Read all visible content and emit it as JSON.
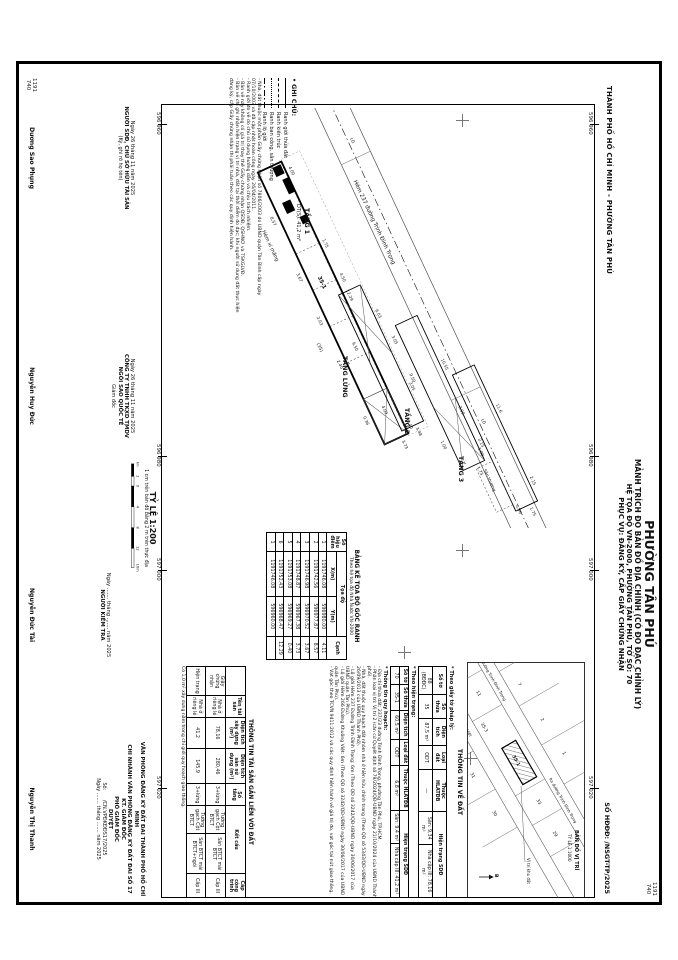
{
  "sheet": {
    "city_line": "THÀNH PHỐ HỒ CHÍ MINH - PHƯỜNG TÂN PHÚ",
    "title": "PHƯỜNG TÂN PHÚ",
    "subtitle1": "MẢNH TRÍCH ĐO BẢN ĐỒ ĐỊA CHÍNH (CÓ ĐO ĐẠC CHỈNH LÝ)",
    "subtitle2": "HỆ TỌA ĐỘ VN-2000, PHƯỜNG TÂN PHÚ, TỜ SỐ: 70",
    "subtitle3": "PHỤC VỤ: ĐĂNG KÝ, CẤP GIẤY CHỨNG NHẬN",
    "doc_no": "SỐ HĐĐĐ:  /NSGT-TP/2025"
  },
  "grid": {
    "ticks": [
      "596 960",
      "596 980",
      "597 000",
      "597 020"
    ],
    "corner_top": "1191",
    "corner_bottom": "740"
  },
  "legend": {
    "title": "• GHI CHÚ:",
    "items": [
      {
        "label": "Ranh giới thửa đất"
      },
      {
        "label": "Ranh kiến trúc"
      },
      {
        "label": "Ranh ban công, sân thượng"
      },
      {
        "label": "Ranh lộ giới"
      }
    ],
    "notes": [
      "- Nhà, đất thuộc một phần Giấy chứng nhận số 7806/2003 do UBND quận Tân Bình cấp ngày 07/10/2003 và đã cập nhật hoàn công ngày 26/04/2011.",
      "- Ranh giới đo vẽ do chủ sử dụng hướng dẫn và chịu trách nhiệm.",
      "- Bản vẽ này không có giá trị thay thế Giấy chứng nhận QSDĐ, QSHNƠ và TSKGLVĐ.",
      "- Bản vẽ chỉ ghi nhận hiện trạng vị trí nhà, đất tại thời điểm đo đạc; khi người sử dụng đất thực hiện đăng ký, cấp Giấy chứng nhận thì phải tuân theo các quy định hiện hành."
    ]
  },
  "map": {
    "street_label": "Hẻm 237 đường Trịnh Đình Trọng",
    "alley_label": "Hẻm xi măng",
    "lg_label": "LG",
    "parcel_label": "35-1",
    "parcel_alt": "(35)",
    "floors": [
      {
        "name": "TẦNG 1",
        "area": "DT(S): 41,2 m²",
        "dims": [
          "4.00",
          "1.75",
          "12.29",
          "0.40",
          "8.57",
          "3.67",
          "2.03",
          "2.40",
          "0.36",
          "3.73"
        ]
      },
      {
        "name": "TẦNG LỬNG",
        "dims": [
          "6.03",
          "3.05",
          "9.50",
          "4.09",
          "3.48",
          "4.50"
        ]
      },
      {
        "name": "TẦNG 2",
        "dims": [
          "10.55",
          "2.15",
          "9.50",
          "1.00",
          "1.75",
          "3.05"
        ]
      },
      {
        "name": "TẦNG 3",
        "dims": [
          "11.6",
          "2.15",
          "3.00",
          "1.00",
          "1.75",
          "0.36"
        ],
        "annex": "Sân thượng"
      }
    ]
  },
  "scale": {
    "title": "TỶ LỆ 1:200",
    "note": "1 cm trên bản đồ bằng 2 m trên thực địa",
    "bar_labels": [
      "4m",
      "2",
      "0",
      "4",
      "8",
      "12",
      "16m"
    ]
  },
  "coord_table": {
    "title": "BẢNG KÊ TỌA ĐỘ GÓC RANH",
    "subtitle": "Theo hệ tọa độ Nhà Nước VN-2000",
    "col_point": "Số hiệu điểm",
    "col_coord": "Tọa độ",
    "col_x": "X(m)",
    "col_y": "Y(m)",
    "col_edge": "Cạnh",
    "rows": [
      {
        "p": "1",
        "x": "1191746.08",
        "y": "596980.00",
        "c": "4.11"
      },
      {
        "p": "2",
        "x": "1191742.56",
        "y": "596977.87",
        "c": "8.57"
      },
      {
        "p": "3",
        "x": "1191746.98",
        "y": "596970.52",
        "c": "3.67"
      },
      {
        "p": "4",
        "x": "1191748.87",
        "y": "596967.38",
        "c": "3.73"
      },
      {
        "p": "5",
        "x": "1191753.08",
        "y": "596969.27",
        "c": "0.40"
      },
      {
        "p": "6",
        "x": "1191752.43",
        "y": "596968.47",
        "c": "12.29"
      },
      {
        "p": "1",
        "x": "1191746.08",
        "y": "596960.00",
        "c": ""
      }
    ]
  },
  "land_info": {
    "title": "THÔNG TIN VỀ ĐẤT",
    "legal_label": "* Theo giấy tờ pháp lý:",
    "current_label": "* Theo hiện trạng:",
    "headers": {
      "to": "Số tờ",
      "thua": "Số thửa",
      "dt": "Diện tích",
      "ld": "Loại đất",
      "hl": "Thuộc HLATĐB",
      "ht": "Hiện trạng SDĐ"
    },
    "legal": {
      "to": "88 (BĐĐC)",
      "thua": "35",
      "dt": "87,5 m²",
      "ld": "ODT",
      "hl": "—",
      "ht1": "Sân: 9,34 m²",
      "ht2": "Nhà cấp III: 78,16 m²"
    },
    "current": {
      "to": "70",
      "thua": "35-1",
      "dt": "60,5 m²",
      "ld": "ODT",
      "hl": "6,8 m²",
      "ht1": "Sân: 9,4 m²",
      "ht2": "Nhà cấp III: 41,2 m²"
    },
    "planning_label": "* Thông tin quy hoạch:",
    "planning_notes": [
      "- Địa chỉ thửa đất: 237/23 đường Trịnh Đình Trọng, phường Tân Phú, TP.HCM.",
      "- Phân loại vị trí: Vị trí 2 (căn cứ Quyết định số 79/2024/QĐ-UBND ngày 21/10/2024 của UBND Thành phố).",
      "- Nhà, đất thuộc quy hoạch đất nhóm nhà ở hiện hữu chỉnh trang (Theo QĐ số 5343/QĐ-UBND ngày 26/09/2013 của UBND Thành Phố).",
      "- Lộ giới Hẻm 237 Đường Trịnh Đình Trọng: 6m (Theo QĐ số 3242/QĐ-UBND ngày 30/06/2017 của UBND quận Tân Phú).",
      "- Lộ giới Hẻm 266 Đường Khuông Việt: 6m (Theo QĐ số 3242/QĐ-UBND ngày 30/06/2017 của UBND quận Tân Phú).",
      "- Vạt góc theo TCVN 9411:2012 và các quy định hiện hành về giá trị đo, vạt góc tại nút giao thông."
    ]
  },
  "asset_info": {
    "title": "THÔNG TIN TÀI SẢN GẮN LIỀN VỚI ĐẤT",
    "headers": {
      "name": "Tên tài sản",
      "dtxd": "Diện tích xây dựng (m²)",
      "dts": "Diện tích sàn sử dụng (m²)",
      "tang": "Số tầng",
      "ketcau": "Kết cấu",
      "cap": "Cấp công trình"
    },
    "rows": [
      {
        "label": "Giấy chứng nhận",
        "name": "Nhà ở riêng lẻ",
        "dtxd": "78,16",
        "dts": "280,46",
        "tang": "3+lửng",
        "kc1": "Tường gạch Cột BTCT",
        "kc2": "Sàn BTCT mái BTCT",
        "cap": "Cấp III"
      },
      {
        "label": "Hiện trạng",
        "name": "Nhà ở riêng lẻ",
        "dtxd": "41,2",
        "dts": "145,9",
        "tang": "3+lửng",
        "kc1": "Tường gạch Cột BTCT",
        "kc2": "Sàn BTCT mái BTCT+ngói",
        "cap": "Cấp III"
      }
    ],
    "note": "Có 1,0 m² xây dựng nằm trong chỉ giới quy hoạch giao thông."
  },
  "inset": {
    "title": "BẢN ĐỒ VỊ TRÍ",
    "scale": "TỶ LỆ 1:1000",
    "location_label": "Vị trí khu đất",
    "north_label": "B",
    "street1": "Hẻm 237 đường Trịnh Đình Trọng",
    "street2": "Ra đường Trịnh Đình Trọng",
    "street3": "Hẻm 266 đường Khuông Việt",
    "parcel_main": "35-1",
    "parcels": [
      "1",
      "2",
      "7",
      "8",
      "3",
      "11",
      "29",
      "30",
      "31",
      "33",
      "34",
      "36",
      "35-3"
    ]
  },
  "signatures": {
    "owner": {
      "date": "Ngày 26 tháng 11 năm 2025",
      "line1": "NGƯỜI SDĐ, CHỦ SỞ HỮU TÀI SẢN",
      "line2": "(Ký, ghi rõ họ tên)",
      "name": "Dương Sao Phụng"
    },
    "company": {
      "date": "Ngày 26 tháng 11 năm 2025",
      "line1": "CÔNG TY TNHH TKXD TMDV",
      "line2": "NGÔI SAO QUỐC TẾ",
      "line3": "Giám đốc",
      "name": "Nguyễn Huy Đức"
    },
    "checker": {
      "date": "Ngày ....... tháng ....... năm 2025",
      "line1": "NGƯỜI KIỂM TRA",
      "name": "Nguyễn Đức Tài"
    },
    "office": {
      "line1": "VĂN PHÒNG ĐĂNG KÝ ĐẤT ĐAI THÀNH PHỐ HỒ CHÍ MINH",
      "line2": "CHI NHÁNH VĂN PHÒNG ĐĂNG KÝ ĐẤT ĐAI SỐ 17",
      "line3": "KT. GIÁM ĐỐC",
      "line4": "PHÓ GIÁM ĐỐC",
      "line5": "DUYỆT",
      "line6": "Số:      /CN.VPĐKĐĐS17/2025",
      "date": "Ngày ....... tháng ....... năm 2025",
      "name": "Nguyễn Thị Thanh"
    }
  }
}
